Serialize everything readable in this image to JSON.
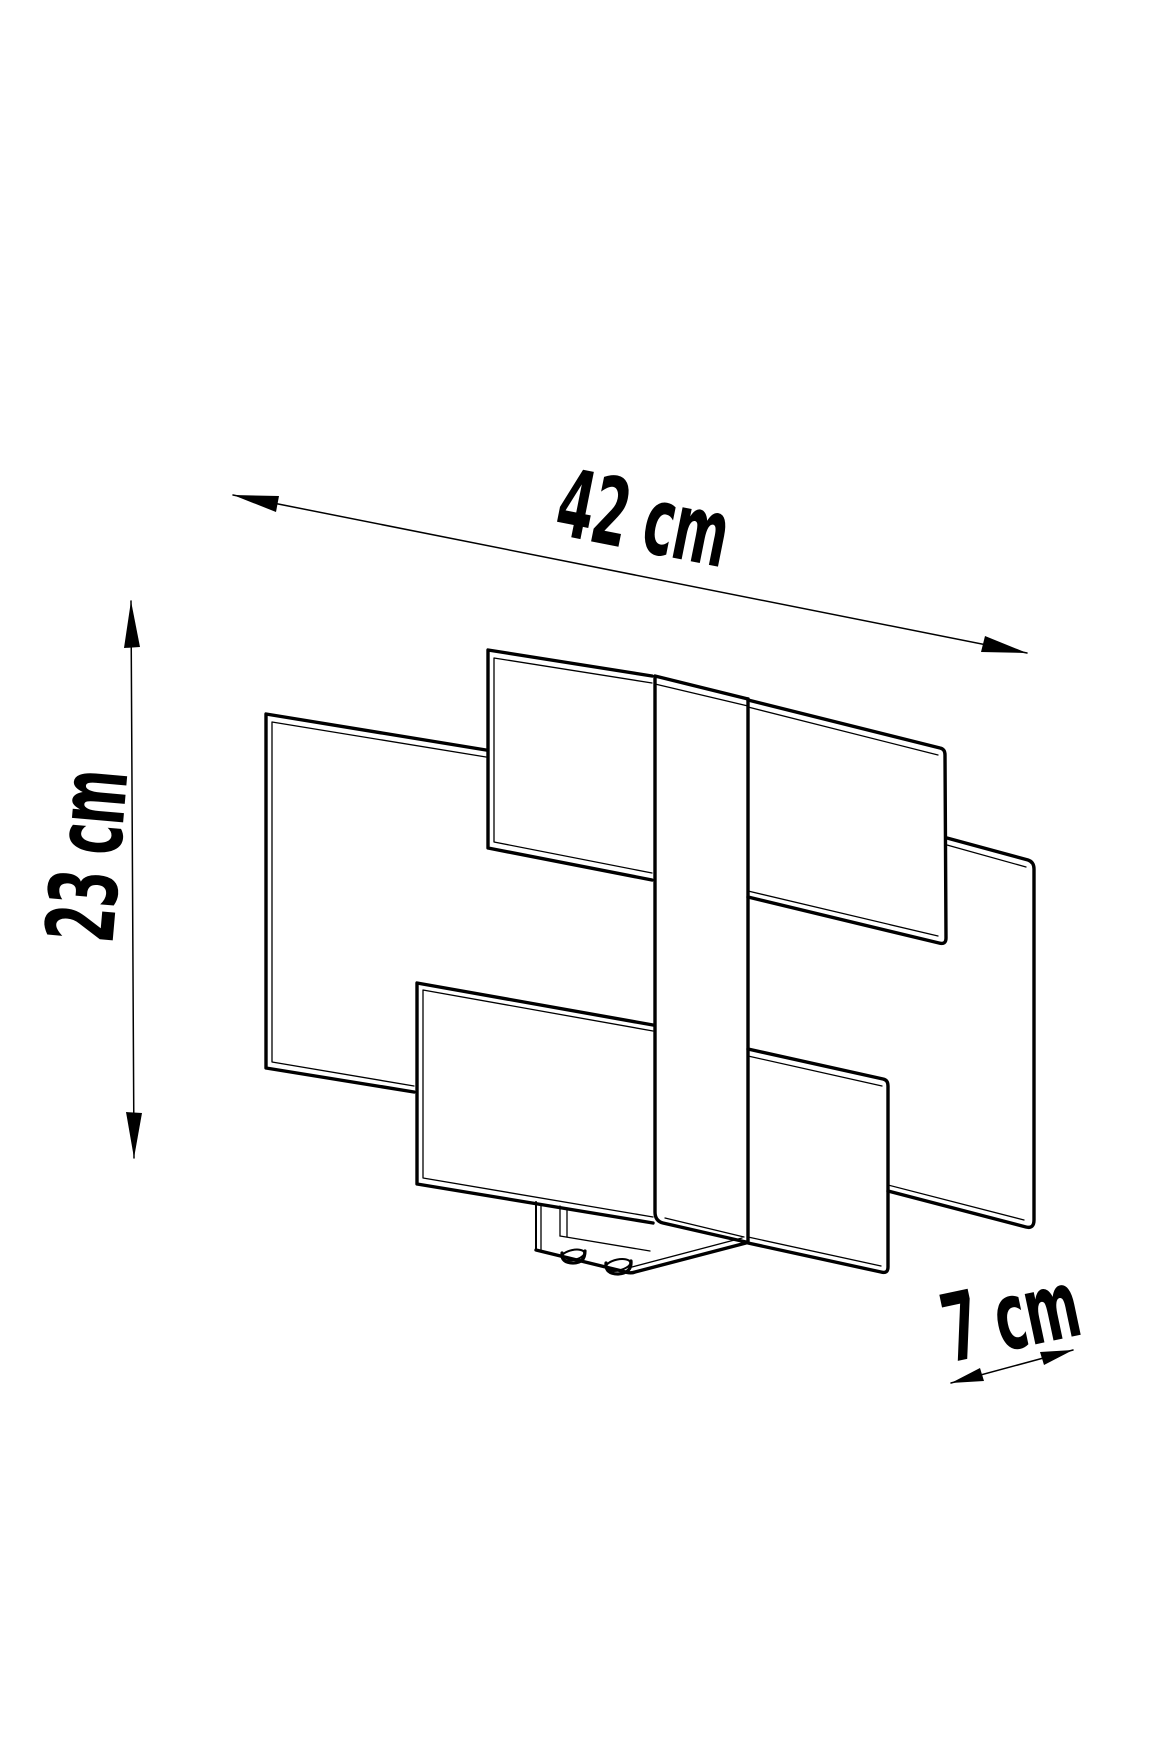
{
  "diagram": {
    "subject": "wall-lamp-technical-dimension-drawing",
    "background": "#ffffff",
    "line_color": "#000000",
    "labels": {
      "width": "42 cm",
      "height": "23 cm",
      "depth": "7 cm"
    }
  }
}
